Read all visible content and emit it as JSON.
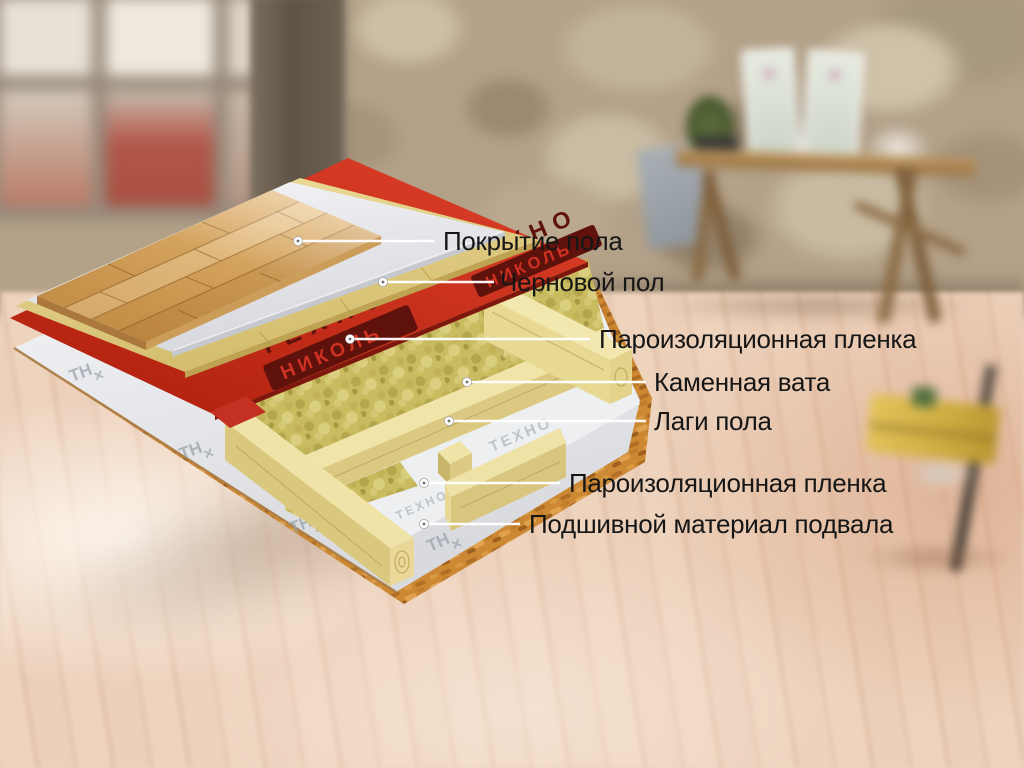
{
  "labels": [
    {
      "text": "Покрытие пола"
    },
    {
      "text": "Черновой пол"
    },
    {
      "text": "Пароизоляционная пленка"
    },
    {
      "text": "Каменная вата"
    },
    {
      "text": "Лаги пола"
    },
    {
      "text": "Пароизоляционная пленка"
    },
    {
      "text": "Подшивной материал подвала"
    }
  ],
  "brand": {
    "techno": "ТЕХНО",
    "nikol": "НИКОЛЬ",
    "tn_mark": "ТН",
    "tn_cross": "✕",
    "film_print": "ТЕХНО"
  },
  "colors": {
    "vapor_film_red": "#c8291b",
    "mineral_wool": "#c9bb60",
    "joist_wood": "#e9dc9e",
    "osb": "#cd8834",
    "film_white": "#eef0f2",
    "parquet": "#d8a75f",
    "label_text": "#161616",
    "leader_line": "#ffffff"
  }
}
